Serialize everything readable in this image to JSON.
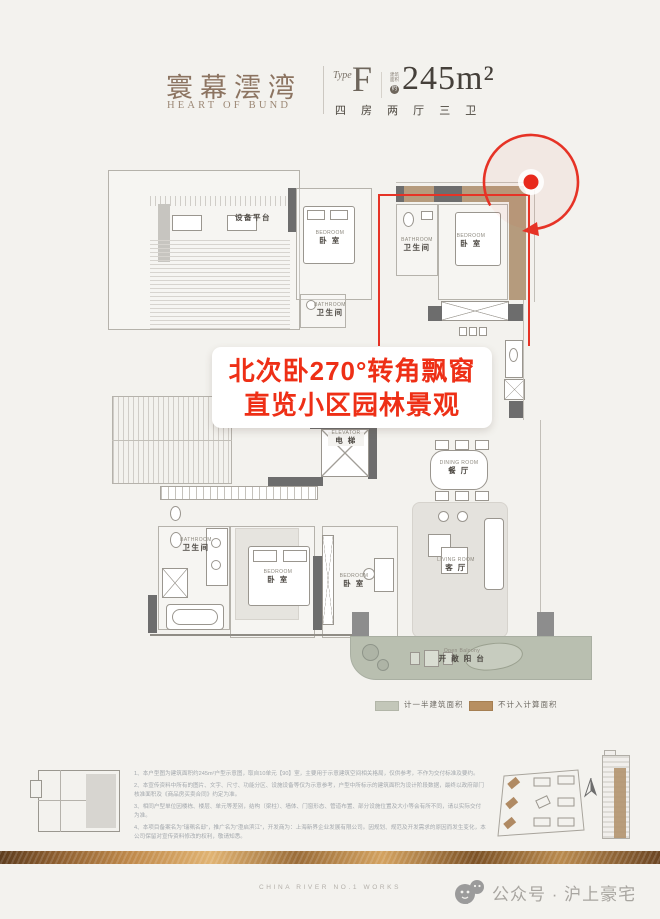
{
  "header": {
    "brand_cn": "寰幕澐湾",
    "brand_en": "HEART OF BUND",
    "type_label": "Type",
    "type_value": "F",
    "area_note": {
      "l1": "建筑",
      "l2": "面积",
      "approx": "约"
    },
    "area_value": "245m²",
    "layout": "四 房 两 厅 三 卫"
  },
  "plan": {
    "rooms": [
      {
        "cn": "设备平台"
      },
      {
        "en": "BEDROOM",
        "cn": "卧 室"
      },
      {
        "en": "BATHROOM",
        "cn": "卫生间"
      },
      {
        "en": "BEDROOM",
        "cn": "卧 室"
      },
      {
        "en": "BATHROOM",
        "cn": "卫生间"
      },
      {
        "en": "ELEVATOR",
        "cn": "电 梯"
      },
      {
        "en": "BATHROOM",
        "cn": "卫生间"
      },
      {
        "en": "BEDROOM",
        "cn": "卧 室"
      },
      {
        "en": "BEDROOM",
        "cn": "卧 室"
      },
      {
        "en": "DINING ROOM",
        "cn": "餐 厅"
      },
      {
        "en": "LIVING ROOM",
        "cn": "客 厅"
      },
      {
        "en": "Open Balcony",
        "cn": "开 敞 阳 台"
      }
    ],
    "callout": {
      "line1": "北次卧270°转角飘窗",
      "line2": "直览小区园林景观"
    },
    "legend": [
      {
        "label": "计一半建筑面积",
        "color": "#c3c7b9"
      },
      {
        "label": "不计入计算面积",
        "color": "#b78f61"
      }
    ]
  },
  "footnotes": {
    "items": [
      "1、本户型图为建筑面积约245m²户型示意图，取自10单元【90】室，主要用于示意建筑空间相关格局，仅供参考，不作为交付标准及要约。",
      "2、本宣传资料中所有的图片、文字、尺寸、功能分区、设施设备等仅为示意参考，户型中所标示的建筑面积为设计阶段数据，最终以政府部门核准面积及《商品房买卖合同》约定为准。",
      "3、相同户型单位因楼栋、楼层、单元等差别，结构（梁柱）、墙体、门窗形态、管道布置、部分设施位置及大小等会有所不同，请以实际交付为准。",
      "4、本项目备案名为“瑞珮名邸”，推广名为“澄启滨江”，开发商为：上海新界企业发展有限公司。因规划、规范及开发需求的原因而发生变化，本公司保留对宣传资料修改的权利，敬请知悉。"
    ]
  },
  "footer": {
    "works_label": "CHINA RIVER NO.1 WORKS",
    "wechat_label": "公众号 · 沪上豪宅"
  },
  "colors": {
    "accent_red": "#e8291c",
    "bay_tan": "#b59b7d",
    "balcony_green": "#b9bfb0",
    "gold": "#b98a4e",
    "brand_bronze": "#8c7461"
  }
}
